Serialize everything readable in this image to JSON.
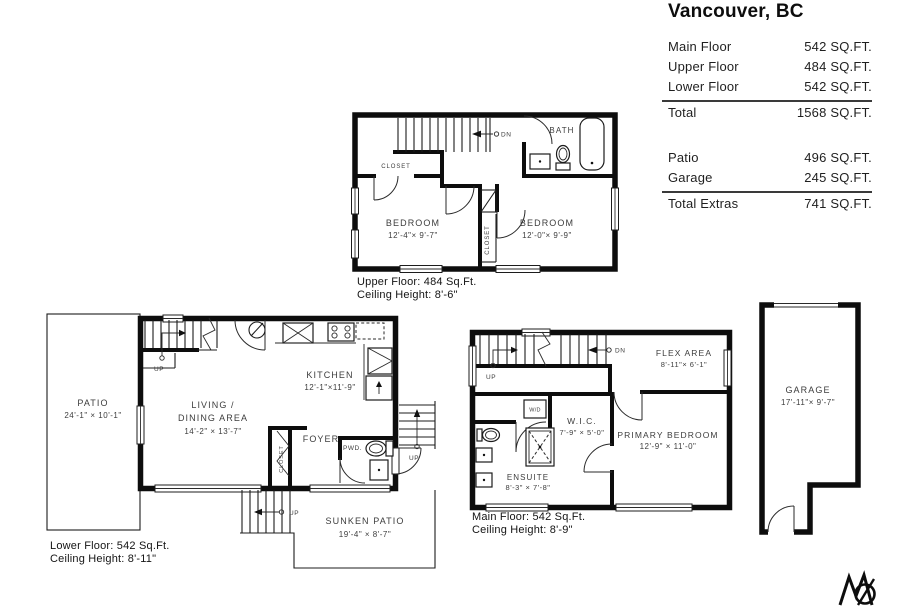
{
  "title": "Vancouver, BC",
  "summary": {
    "floors": [
      {
        "label": "Main Floor",
        "value": "542 SQ.FT."
      },
      {
        "label": "Upper Floor",
        "value": "484 SQ.FT."
      },
      {
        "label": "Lower Floor",
        "value": "542 SQ.FT."
      }
    ],
    "total": {
      "label": "Total",
      "value": "1568 SQ.FT."
    },
    "extras": [
      {
        "label": "Patio",
        "value": "496 SQ.FT."
      },
      {
        "label": "Garage",
        "value": "245 SQ.FT."
      }
    ],
    "total_extras": {
      "label": "Total Extras",
      "value": "741 SQ.FT."
    }
  },
  "upper": {
    "caption1": "Upper Floor: 484 Sq.Ft.",
    "caption2": "Ceiling Height: 8'-6\"",
    "bedroom1_name": "BEDROOM",
    "bedroom1_dims": "12'-4\"× 9'-7\"",
    "bedroom2_name": "BEDROOM",
    "bedroom2_dims": "12'-0\"× 9'-9\"",
    "bath_label": "BATH",
    "closet_label": "CLOSET",
    "closet2_label": "CLOSET",
    "dn_label": "DN"
  },
  "lower": {
    "caption1": "Lower Floor: 542 Sq.Ft.",
    "caption2": "Ceiling Height: 8'-11\"",
    "patio_name": "PATIO",
    "patio_dims": "24'-1\" × 10'-1\"",
    "living_line1": "LIVING /",
    "living_line2": "DINING AREA",
    "living_dims": "14'-2\" × 13'-7\"",
    "kitchen_name": "KITCHEN",
    "kitchen_dims": "12'-1\"×11'-9\"",
    "foyer_label": "FOYER",
    "pwd_label": "PWD.",
    "closet_label": "CLOSET",
    "sunken_name": "SUNKEN PATIO",
    "sunken_dims": "19'-4\" × 8'-7\"",
    "up_label": "UP",
    "up_label_ext": "UP",
    "up_label_patio": "UP"
  },
  "main": {
    "caption1": "Main Floor: 542 Sq.Ft.",
    "caption2": "Ceiling Height: 8'-9\"",
    "flex_name": "FLEX AREA",
    "flex_dims": "8'-11\"× 6'-1\"",
    "primary_name": "PRIMARY BEDROOM",
    "primary_dims": "12'-9\" × 11'-0\"",
    "wic_name": "W.I.C.",
    "wic_dims": "7'-9\" × 5'-0\"",
    "ensuite_name": "ENSUITE",
    "ensuite_dims": "8'-3\" × 7'-8\"",
    "wd_label": "W/D",
    "up_label": "UP",
    "dn_label": "DN"
  },
  "garage": {
    "name": "GARAGE",
    "dims": "17'-11\"× 9'-7\""
  }
}
